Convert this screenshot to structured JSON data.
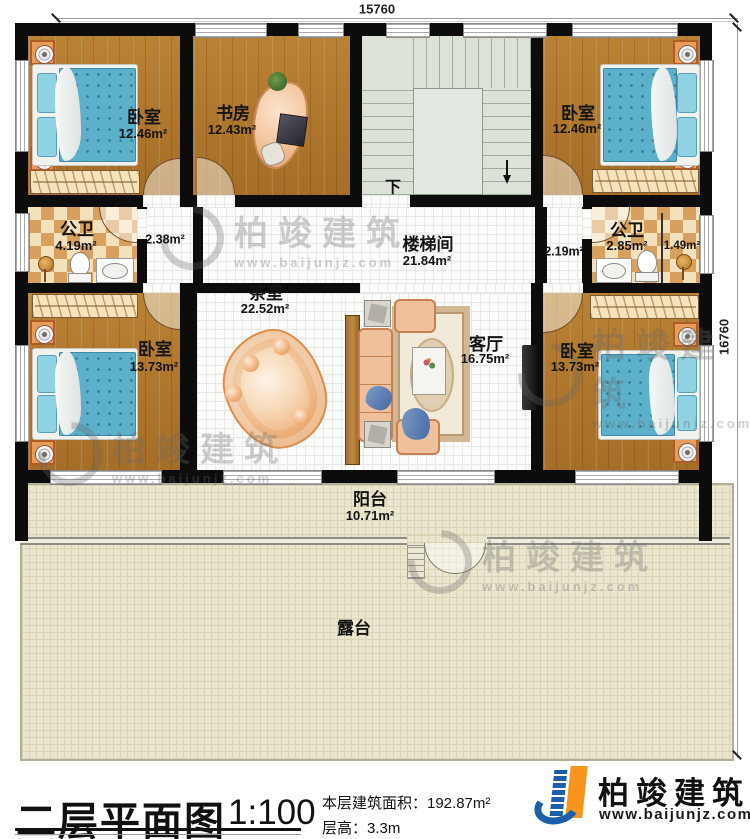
{
  "dimensions": {
    "top": "15760",
    "right": "16760"
  },
  "rooms": {
    "bedroom_tl": {
      "name": "卧室",
      "area": "12.46m²"
    },
    "study": {
      "name": "书房",
      "area": "12.43m²"
    },
    "bedroom_tr": {
      "name": "卧室",
      "area": "12.46m²"
    },
    "bath_left": {
      "name": "公卫",
      "area": "4.19m²"
    },
    "hall_left": {
      "area": "2.38m²"
    },
    "stairwell": {
      "name": "楼梯间",
      "area": "21.84m²"
    },
    "hall_right": {
      "area": "2.19m²"
    },
    "bath_right": {
      "name": "公卫",
      "area": "2.85m²"
    },
    "shower_right": {
      "area": "1.49m²"
    },
    "tea_room": {
      "name": "茶室",
      "area": "22.52m²"
    },
    "living_room": {
      "name": "客厅",
      "area": "16.75m²"
    },
    "bedroom_bl": {
      "name": "卧室",
      "area": "13.73m²"
    },
    "bedroom_br": {
      "name": "卧室",
      "area": "13.73m²"
    },
    "balcony": {
      "name": "阳台",
      "area": "10.71m²"
    },
    "terrace": {
      "name": "露台"
    }
  },
  "stair": {
    "down_label": "下"
  },
  "watermark": {
    "brand": "柏竣建筑",
    "url": "www.baijunjz.com"
  },
  "footer": {
    "title": "二层平面图",
    "scale": "1:100",
    "floor_area_label": "本层建筑面积：192.87m²",
    "floor_height_label": "层高：3.3m",
    "brand": "柏竣建筑",
    "brand_url": "www.baijunjz.com"
  },
  "colors": {
    "wall": "#0c0c0c",
    "wood_floor": "#ae7730",
    "bed_blue": "#5cb0ca",
    "bath_tile_tan": "#d7a05f",
    "terrace_cream": "#ebe6d0",
    "brand_blue": "#1a5fa8",
    "brand_orange": "#f7941d"
  }
}
